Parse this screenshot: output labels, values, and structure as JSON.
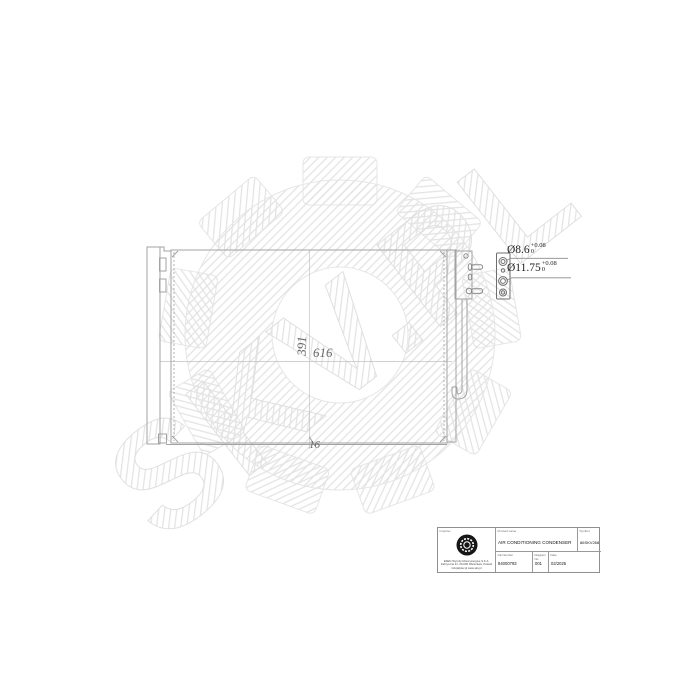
{
  "watermark": {
    "text": "SKV.PL"
  },
  "drawing": {
    "dimensions": {
      "core_height": "391",
      "core_width": "616",
      "core_depth": "16",
      "port_small": {
        "prefix": "Ø8.6",
        "sup": "+0.08",
        "sub": "0"
      },
      "port_large": {
        "prefix": "Ø11.75",
        "sup": "+0.08",
        "sub": "0"
      }
    }
  },
  "title_block": {
    "importer_label": "Importer",
    "address": [
      "ESEN Wyroby Motoryzacyjne S.K.A.",
      "Fabryczna 21, 00-000 Warszawa, Poland",
      "info(at)skv.pl  www.skv.pl"
    ],
    "product_name_label": "Product name",
    "product_name": "AIR CONDITIONING CONDENSER",
    "symbol_label": "Symbol",
    "symbol": "86SKV268",
    "ce_number_label": "CE Number",
    "ce_number": "84000793",
    "diagram_no_label": "Diagram No.",
    "diagram_no": "001",
    "date_label": "Date",
    "date": "02/2025"
  }
}
